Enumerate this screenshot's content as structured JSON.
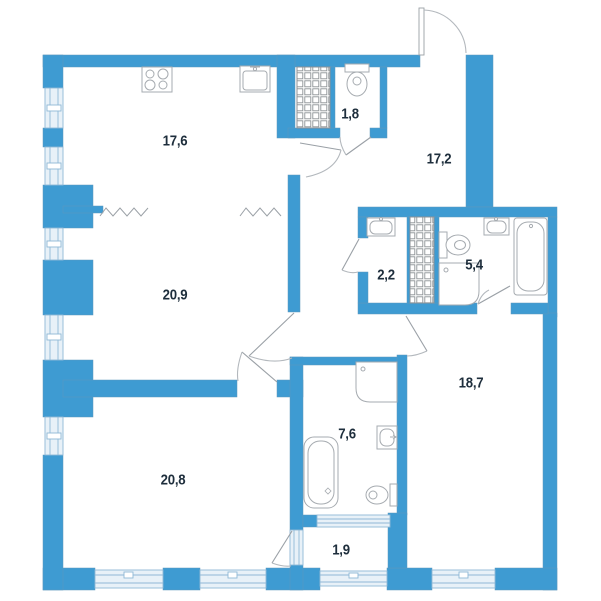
{
  "plan_title": "apartment-floor-plan",
  "colors": {
    "wall_blue": "#3e9bd2",
    "wall_edge": "#5f97bd",
    "window_fill": "#e8f1f8",
    "window_frame": "#8fb8d6",
    "fixture_outline": "#a6abb0",
    "door_line": "#9aa0a6",
    "hatch_line": "#8d9296",
    "label_color": "#1e2e3c",
    "background": "#ffffff"
  },
  "rooms": [
    {
      "id": "kitchen",
      "label": "17,6"
    },
    {
      "id": "wc",
      "label": "1,8"
    },
    {
      "id": "hallway",
      "label": "17,2"
    },
    {
      "id": "living",
      "label": "20,9"
    },
    {
      "id": "laundry",
      "label": "2,2"
    },
    {
      "id": "bathroom-2",
      "label": "5,4"
    },
    {
      "id": "bedroom-2",
      "label": "18,7"
    },
    {
      "id": "bathroom-1",
      "label": "7,6"
    },
    {
      "id": "bedroom-1",
      "label": "20,8"
    },
    {
      "id": "balcony",
      "label": "1,9"
    }
  ],
  "fixtures": [
    "stove",
    "kitchen-sink",
    "toilet-wc",
    "washbasin-laundry",
    "toilet-bathroom-2",
    "shower-tray-bathroom-2",
    "washbasin-bathroom-2",
    "bathtub-bathroom-2",
    "shower-tray-bathroom-1",
    "washbasin-bathroom-1",
    "toilet-bathroom-1",
    "bathtub-bathroom-1"
  ],
  "symbols": [
    "vent-shaft",
    "vent-shaft",
    "open-plan-zigzag",
    "door-swing"
  ]
}
